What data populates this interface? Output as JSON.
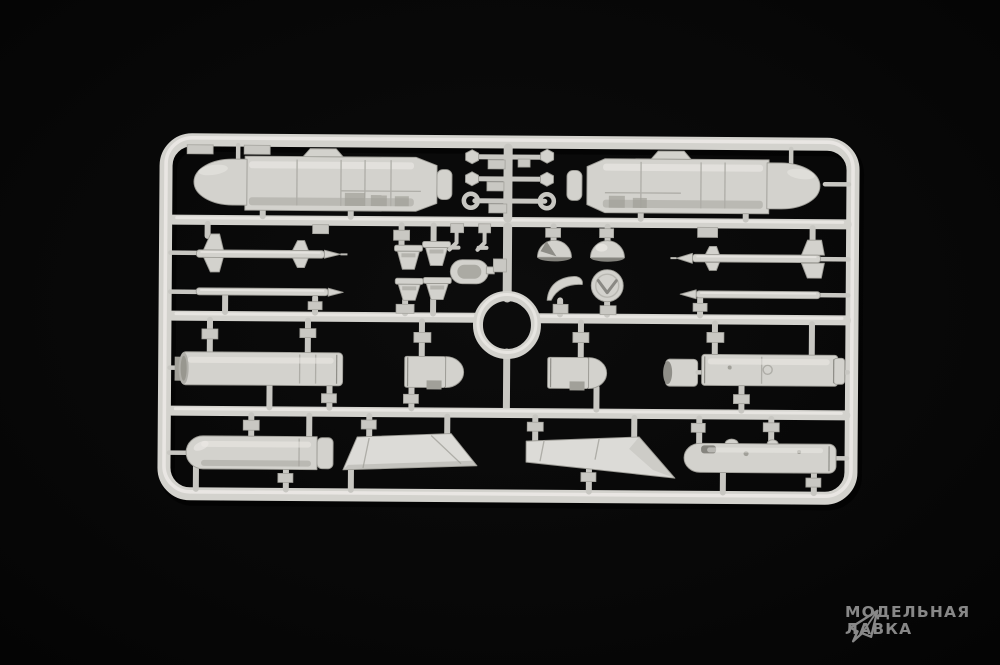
{
  "scene": {
    "type": "product-photo",
    "subject": "injection-molded plastic model kit sprue (weapons set) on black background",
    "plastic_color_name": "light grey",
    "background_color_name": "black"
  },
  "colors": {
    "background": "#060606",
    "plastic": "#d3d2cd",
    "plastic_highlight": "#eceae6",
    "plastic_shadow": "#a1a099",
    "watermark": "#8f8f8f"
  },
  "watermark": {
    "line1": "МОДЕЛЬНАЯ",
    "line2": "ЛАВКА",
    "icon": "paper-plane-logo"
  },
  "sprue": {
    "rows": 4,
    "center_feature": "molded ring in middle runner",
    "parts": [
      {
        "id": "cruise-missile-pod-left",
        "label": "large pod/missile body half, nose left"
      },
      {
        "id": "cruise-missile-pod-right",
        "label": "large pod/missile body half, nose right"
      },
      {
        "id": "actuator-rod-hex-1",
        "label": "small rod with hex ends"
      },
      {
        "id": "actuator-rod-hex-2",
        "label": "small rod with hex ends"
      },
      {
        "id": "actuator-rod-eyelet",
        "label": "small rod with eyelet ends"
      },
      {
        "id": "missile-half-finned-left",
        "label": "slender finned missile half pointing right"
      },
      {
        "id": "missile-half-plain-left",
        "label": "slender missile half pointing right"
      },
      {
        "id": "missile-half-finned-right",
        "label": "slender finned missile half pointing left"
      },
      {
        "id": "missile-half-plain-right",
        "label": "slender missile half pointing left"
      },
      {
        "id": "nozzle-cup-1",
        "label": "small cup/nozzle"
      },
      {
        "id": "nozzle-cup-2",
        "label": "small cup/nozzle"
      },
      {
        "id": "nozzle-cup-3",
        "label": "small cup/nozzle"
      },
      {
        "id": "nozzle-cup-4",
        "label": "small cup/nozzle"
      },
      {
        "id": "bracket-small-1",
        "label": "tiny angled bracket"
      },
      {
        "id": "bracket-small-2",
        "label": "tiny angled bracket"
      },
      {
        "id": "intake-ring",
        "label": "stadium-shaped intake ring"
      },
      {
        "id": "dome-sliced",
        "label": "dome/radome with slice cut"
      },
      {
        "id": "dome-plain",
        "label": "smooth dome/radome"
      },
      {
        "id": "crescent-shell",
        "label": "crescent shell piece"
      },
      {
        "id": "disc-cap",
        "label": "round cap with chevron detail"
      },
      {
        "id": "rocket-pod-tube-left",
        "label": "long cylindrical pod tube"
      },
      {
        "id": "pod-nose-1",
        "label": "short rounded pod nose"
      },
      {
        "id": "pod-nose-2",
        "label": "short rounded pod nose"
      },
      {
        "id": "tube-end-cap",
        "label": "short open tube segment"
      },
      {
        "id": "rocket-pod-tube-right",
        "label": "long cylindrical pod tube with end ring"
      },
      {
        "id": "drop-tank-half",
        "label": "round-nosed tank half"
      },
      {
        "id": "wing-panel-left",
        "label": "swept flat wing/fin panel"
      },
      {
        "id": "wing-panel-right",
        "label": "swept flat wing/fin panel"
      },
      {
        "id": "torpedo-body-half",
        "label": "round-ended body half with bumps"
      },
      {
        "id": "center-ring",
        "label": "circular ring molded into runner"
      }
    ]
  }
}
